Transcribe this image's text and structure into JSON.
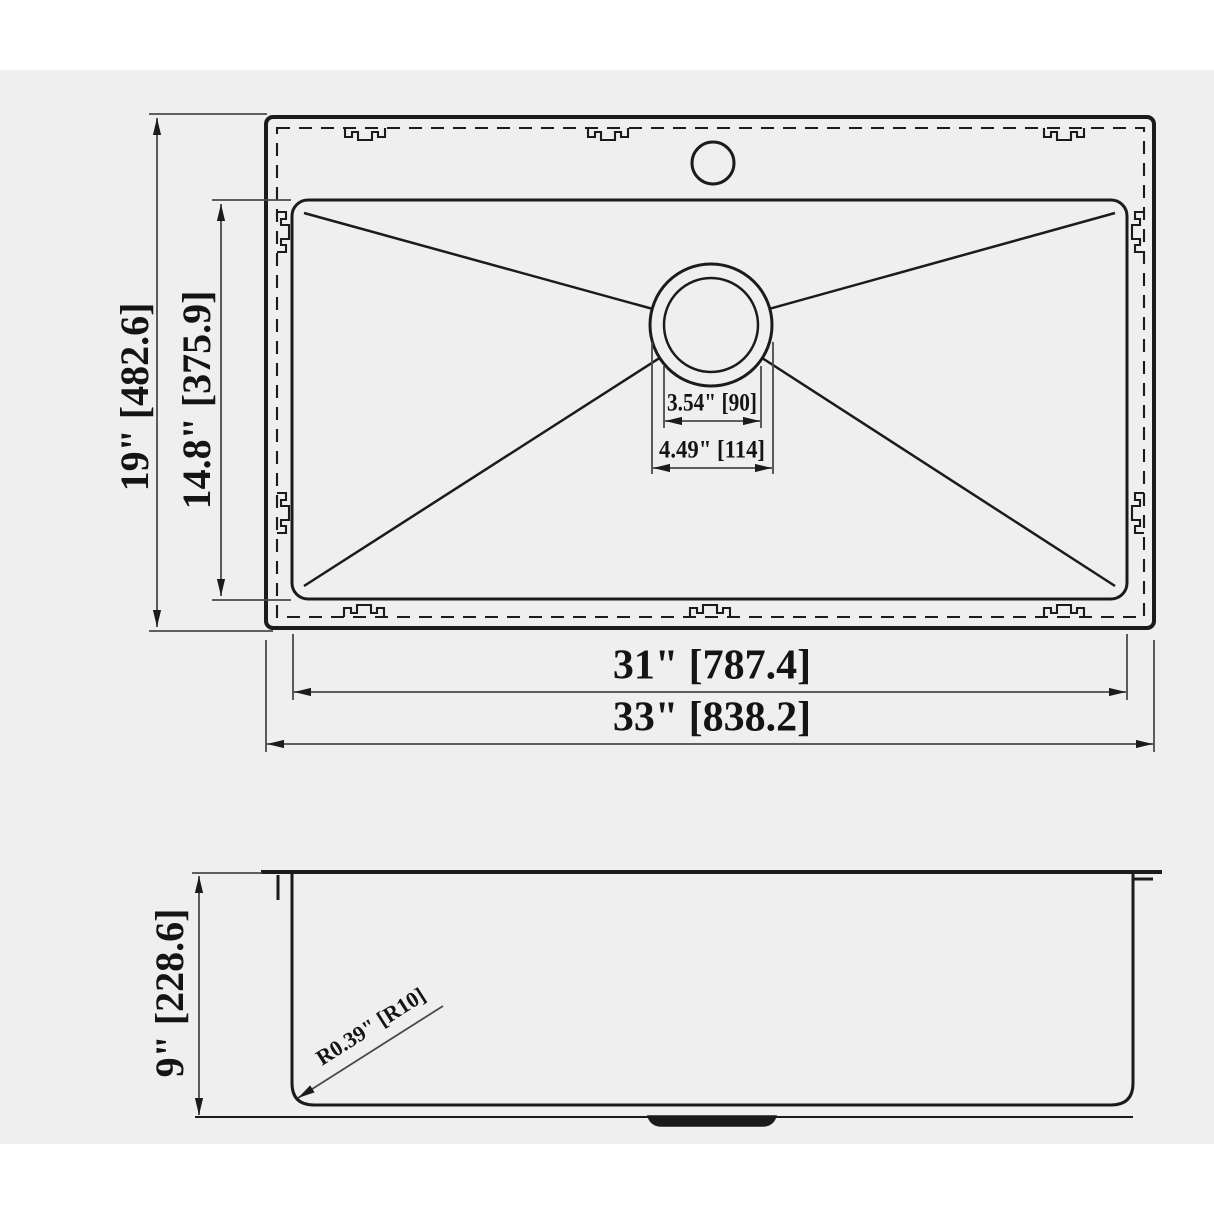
{
  "drawing_type": "sink technical drawing",
  "colors": {
    "canvas_bg": "#efefef",
    "page_bg": "#ffffff",
    "object_line": "#1b1b1b",
    "dimension_line": "#4a4a4a",
    "text": "#141414"
  },
  "top_view": {
    "labels": {
      "height_outer": "19\" [482.6]",
      "height_bowl": "14.8\" [375.9]",
      "drain_inner_dia": "3.54\" [90]",
      "drain_outer_dia": "4.49\" [114]",
      "width_bowl": "31\" [787.4]",
      "width_outer": "33\" [838.2]"
    }
  },
  "side_view": {
    "labels": {
      "depth": "9\" [228.6]",
      "corner_radius": "R0.39\" [R10]"
    }
  }
}
